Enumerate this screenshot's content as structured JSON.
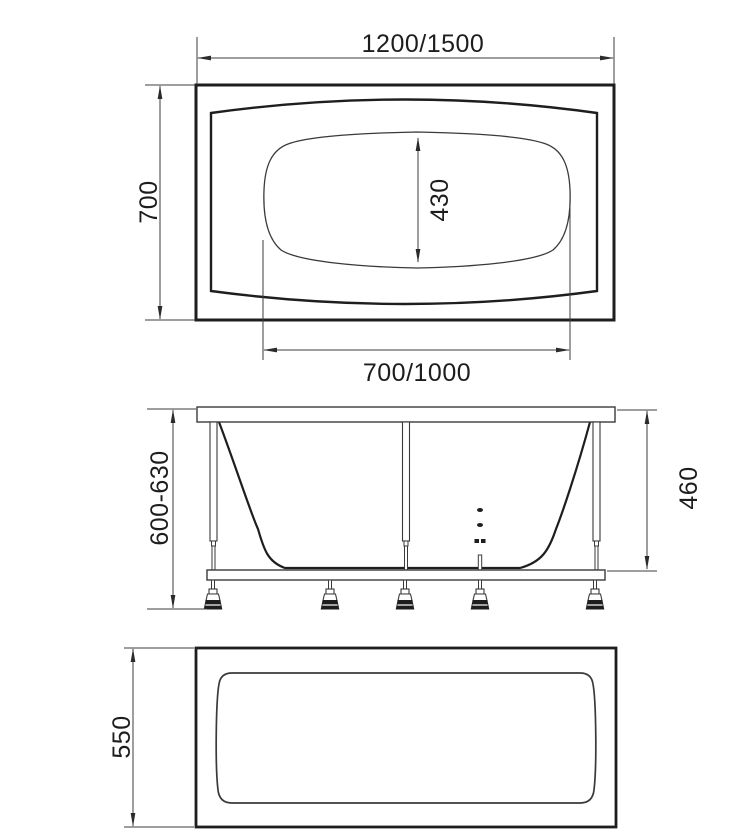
{
  "drawing": {
    "type": "bathtub technical drawing, three orthographic views",
    "background": "#ffffff",
    "line_color": "#1e1e1e",
    "dim_line_color": "#3c3c3c",
    "text_color": "#1d1d1d",
    "top_view": {
      "dim_overall_length": "1200/1500",
      "dim_overall_width": "700",
      "dim_basin_width": "430",
      "dim_basin_length": "700/1000"
    },
    "front_view": {
      "dim_install_height": "600-630",
      "dim_shell_height": "460"
    },
    "panel_view": {
      "dim_panel_height": "550"
    }
  }
}
